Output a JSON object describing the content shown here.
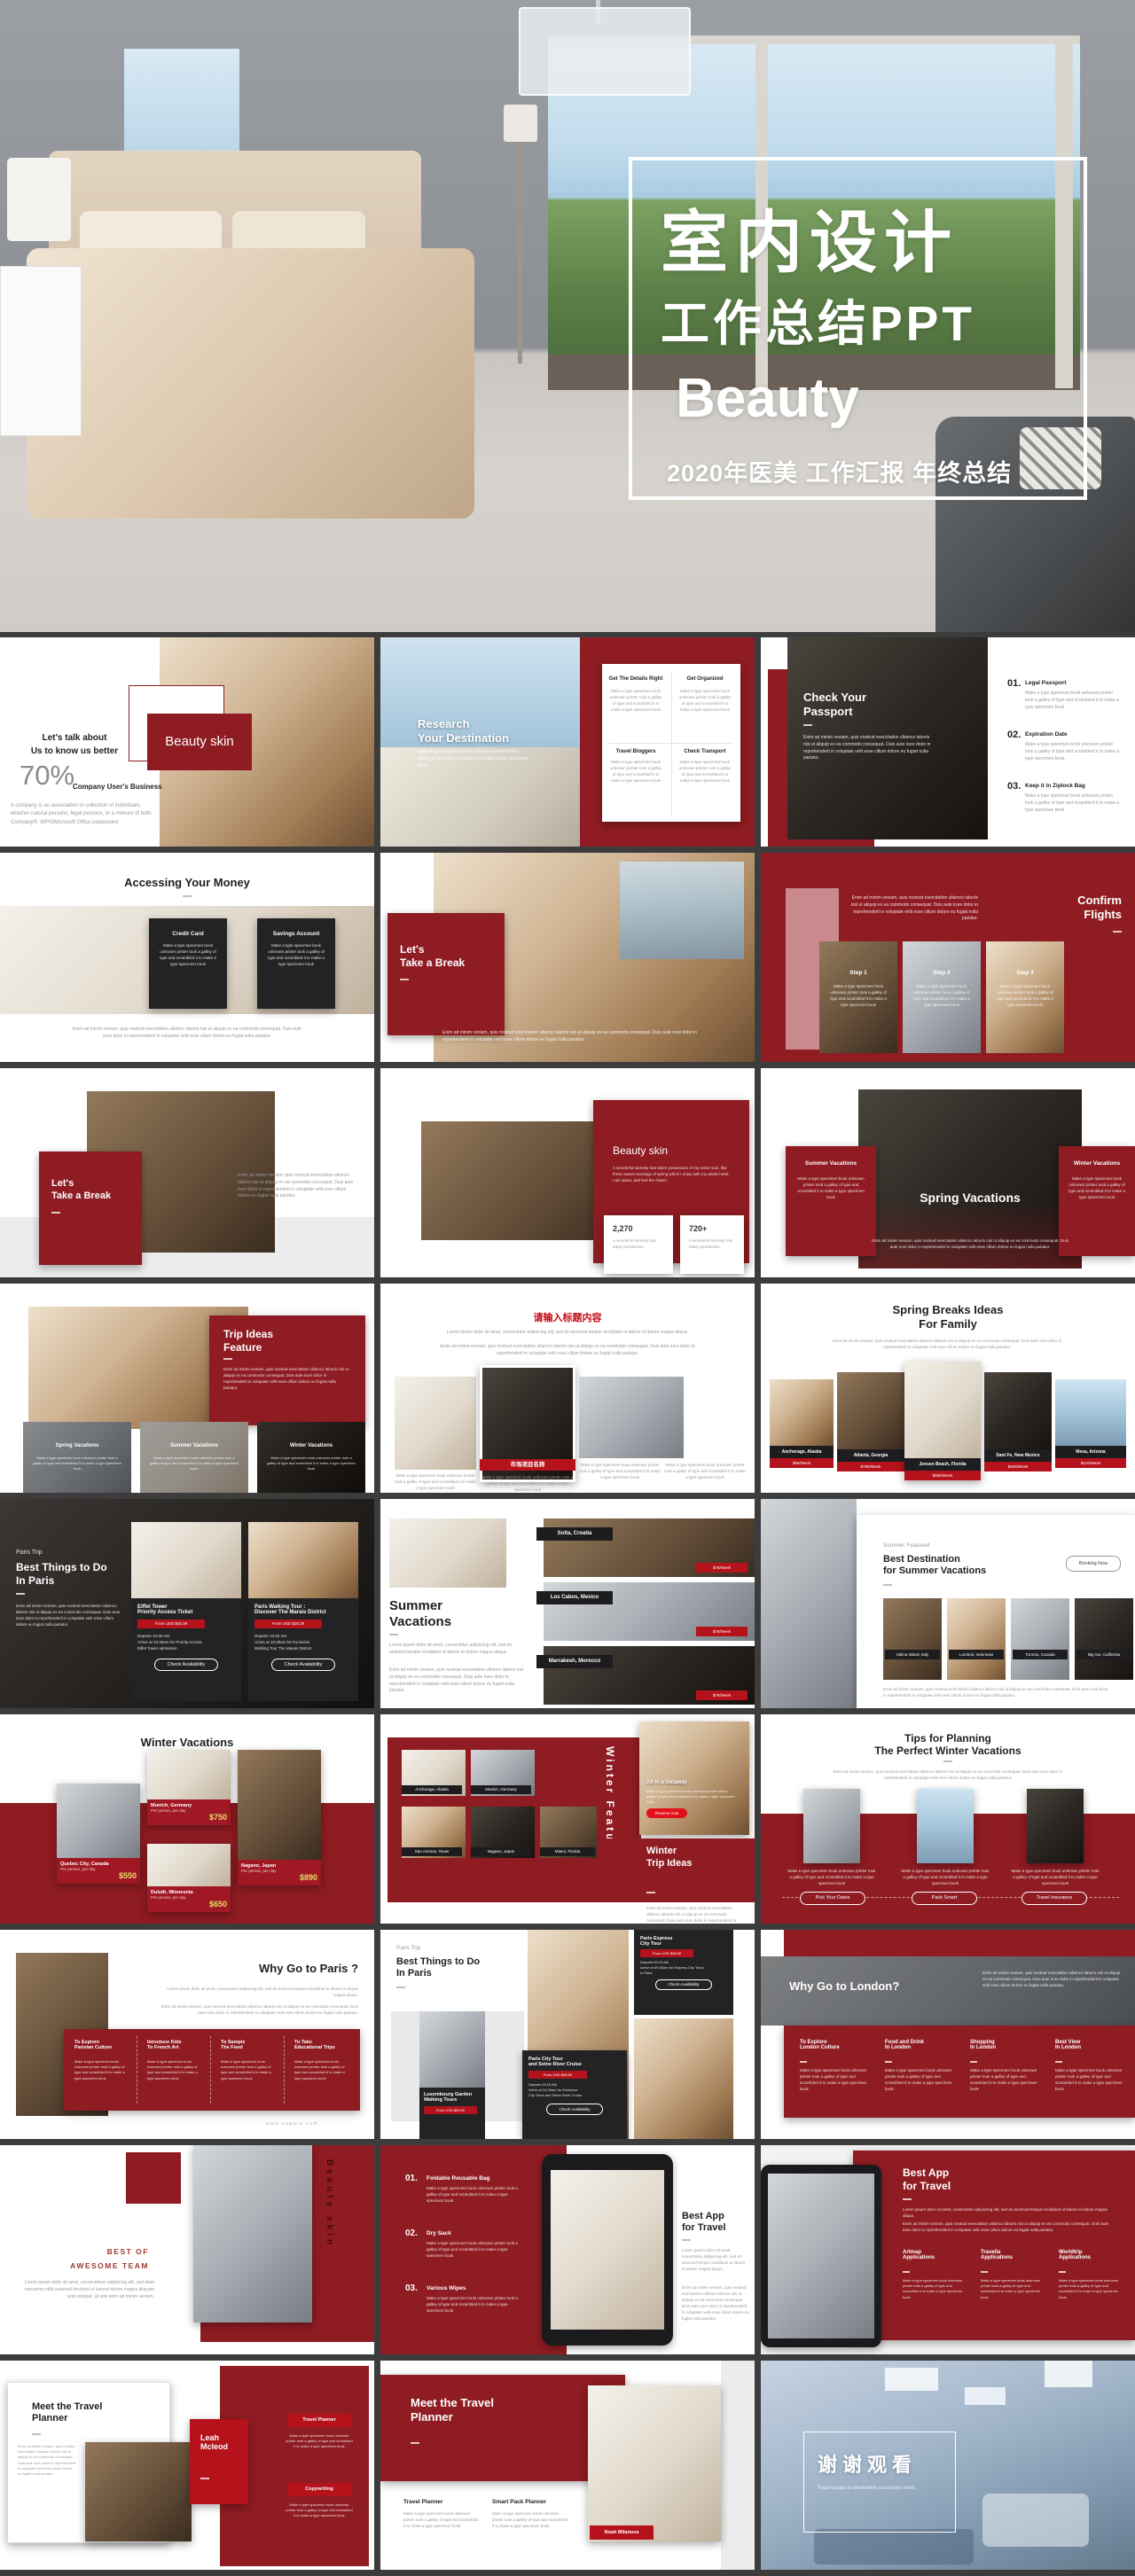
{
  "hero": {
    "title_line1": "室内设计",
    "title_line2": "工作总结PPT",
    "title_line3": "Beauty",
    "subtitle": "2020年医美 工作汇报 年终总结"
  },
  "filler": {
    "spec": "Make a type specimen book unknown printer took a galley of type and scrambled it to make a type specimen book",
    "lorem1": "Lorem ipsum dolor sit amet, consectetur adipiscing elit, sed do eiusmod tempor incididunt ut labore et dolore magna aliqua.",
    "lorem2": "Enim ad minim veniam, quis nostrud exercitation ullamco laboris nisi ut aliquip ex ea commodo consequat. Duis aute irure dolor in reprehenderit in voluptate velit esse cillum dolore eu fugiat nulla pariatur."
  },
  "slides": [
    {
      "badge": "Beauty skin",
      "intro": "Let's talk about\nUs to know us better",
      "stat": "70%",
      "stat_label": "Company User's Business",
      "body": "A company is an association or collection of individuals, whether natural persons, legal persons, or a mixture of both. Company®, WPS/Microsoft Office powerpoint"
    },
    {
      "title": "Research\nYour Destination",
      "cards": [
        {
          "t": "Get The Details Right"
        },
        {
          "t": "Get Organized"
        },
        {
          "t": "Travel Bloggers"
        },
        {
          "t": "Check Transport"
        }
      ]
    },
    {
      "title": "Check Your\nPassport",
      "items": [
        {
          "n": "01.",
          "t": "Legal Passport"
        },
        {
          "n": "02.",
          "t": "Expiration Date"
        },
        {
          "n": "03.",
          "t": "Keep it in Ziplock Bag"
        }
      ]
    },
    {
      "title": "Accessing Your Money",
      "cards": [
        {
          "t": "Credit Card"
        },
        {
          "t": "Savings Account"
        }
      ]
    },
    {
      "title": "Let's\nTake a Break"
    },
    {
      "title": "Confirm\nFlights",
      "steps": [
        "Step 1",
        "Step 2",
        "Step 3"
      ]
    },
    {
      "title": "Let's\nTake a Break"
    },
    {
      "title": "Beauty skin",
      "body": "A wonderful serenity has taken possession of my entire soul, like these sweet mornings of spring which I enjoy with my whole heart. I am alone, and feel the charm.",
      "stats": [
        {
          "v": "2,270",
          "l": "A wonderful serenity has taken possession"
        },
        {
          "v": "720+",
          "l": "A wonderful serenity has taken possession"
        }
      ]
    },
    {
      "title": "Spring Vacations",
      "left": "Summer Vacations",
      "right": "Winter Vacations"
    },
    {
      "title": "Trip Ideas\nFeature",
      "cards": [
        "Spring Vacations",
        "Summer Vacations",
        "Winter Vacations"
      ]
    },
    {
      "title": "请输入标题内容",
      "tag": "市场项目名称"
    },
    {
      "title": "Spring Breaks Ideas\nFor Family",
      "cards": [
        {
          "city": "Anchorage, Alaska",
          "price": "$96/Week"
        },
        {
          "city": "Atlanta, Georgia",
          "price": "$795/Week"
        },
        {
          "city": "Jensen Beach, Florida",
          "price": "$856/Week"
        },
        {
          "city": "Sant Fe, New Mexico",
          "price": "$805/Week"
        },
        {
          "city": "Mesa, Arizona",
          "price": "$116/Week"
        }
      ]
    },
    {
      "kicker": "Paris Trip",
      "title": "Best Things to Do\nIn Paris",
      "cards": [
        {
          "t": "Eiffel Tower\nPriority Access Ticket",
          "price": "From USD $48.39",
          "d": "Departs 10:45 AM\nArrive at 10:30am for Priority Access\nEiffel Tower admission",
          "btn": "Check Availability"
        },
        {
          "t": "Paris Walking Tour :\nDiscover The Marais District",
          "price": "From USD $28.39",
          "d": "Departs 10:45 AM\nArrive at 10:30am for Exclusive\nWalking Tour The Marais District",
          "btn": "Check Availability"
        }
      ]
    },
    {
      "title": "Summer\nVacations",
      "rows": [
        {
          "city": "Solta, Croatia",
          "price": "$78/Week"
        },
        {
          "city": "Los Cabos, Mexico",
          "price": "$78/Week"
        },
        {
          "city": "Marrakesh, Morocco",
          "price": "$78/Week"
        }
      ]
    },
    {
      "kicker": "Summer Featured",
      "title": "Best Destination\nfor Summer Vacations",
      "btn": "Booking Now",
      "cards": [
        "Salina Island, Italy",
        "Lombok, Indonesia",
        "Toronto, Canada",
        "Big Sur, California"
      ]
    },
    {
      "title": "Winter Vacations",
      "cards": [
        {
          "city": "Munich, Germany",
          "sub": "Per person, per day",
          "price": "$750"
        },
        {
          "city": "Quebec City, Canada",
          "sub": "Per person, per day",
          "price": "$550"
        },
        {
          "city": "Duluth, Minnesota",
          "sub": "Per person, per day",
          "price": "$650"
        },
        {
          "city": "Nagano, Japan",
          "sub": "Per person, per day",
          "price": "$890"
        }
      ]
    },
    {
      "vtitle": "Winter Feature",
      "labels": [
        "Anchorage, Alaska",
        "Munich, Germany",
        "San Antonio, Texas",
        "Nagano, Japan",
        "Miami, Florida"
      ],
      "feat": "All In a Getaway",
      "btn": "Reserve now",
      "title": "Winter\nTrip Ideas"
    },
    {
      "title": "Tips for Planning\nThe Perfect Winter Vacations",
      "btns": [
        "Pick Your Dates",
        "Pack Smart",
        "Travel Insurance"
      ]
    },
    {
      "title": "Why Go to Paris ?",
      "cols": [
        {
          "t": "To Explore\nParisian Culture"
        },
        {
          "t": "Introduce Kids\nTo French Art"
        },
        {
          "t": "To Sample\nThe Food"
        },
        {
          "t": "To Take\nEducational Trips"
        }
      ],
      "url": "www.sugara.com"
    },
    {
      "kicker": "Paris Trip",
      "title": "Best Things to Do\nIn Paris",
      "cards": [
        {
          "t": "Luxembourg Garden\nWalking Tours",
          "price": "From USD $69.59"
        },
        {
          "t": "Paris City Tour\nand Seine River Cruise",
          "price": "From USD $36.59",
          "d": "Departs 09:15 AM\nArrive at 09:30am for Exclusive\nCity Tours and Seine River Cruise",
          "btn": "Check Availability"
        },
        {
          "t": "Paris Express\nCity Tour",
          "price": "From USD $38.59",
          "d": "Departs 09:15 AM\nArrive at 09:30am for Express City Tours\nin Paris",
          "btn": "Check Availability"
        }
      ]
    },
    {
      "title": "Why Go to London?",
      "cols": [
        {
          "t": "To Explore\nLondon Culture"
        },
        {
          "t": "Food and Drink\nIn London"
        },
        {
          "t": "Shopping\nIn London"
        },
        {
          "t": "Best View\nIn London"
        }
      ]
    },
    {
      "title": "BEST OF\nAWESOME TEAM",
      "body": "Lorem ipsum dolor sit amet, consectetuer adipiscing elit, sed diam nonummy nibh euismod tincidunt ut laoreet dolore magna aliquam erat volutpat. Ut wisi enim ad minim veniam.",
      "vtext": "Beauty skin"
    },
    {
      "items": [
        {
          "n": "01.",
          "t": "Foldable Reusable Bag"
        },
        {
          "n": "02.",
          "t": "Dry Sack"
        },
        {
          "n": "03.",
          "t": "Various Wipes"
        }
      ],
      "title": "Best App\nfor Travel"
    },
    {
      "title": "Best App\nfor Travel",
      "cols": [
        {
          "t": "Artmap\nApplications"
        },
        {
          "t": "Travelia\nApplications"
        },
        {
          "t": "Worldtrip\nApplications"
        }
      ]
    },
    {
      "title": "Meet the Travel\nPlanner",
      "person": "Leah\nMcleod",
      "badges": [
        "Travel Planner",
        "Copywriting"
      ]
    },
    {
      "title": "Meet the Travel\nPlanner",
      "cols": [
        "Travel Planner",
        "Smart Pack Planner"
      ],
      "tag": "Noah Milanova"
    },
    {
      "title": "谢谢观看",
      "subtitle": "Travel guides to destination around the world"
    }
  ]
}
